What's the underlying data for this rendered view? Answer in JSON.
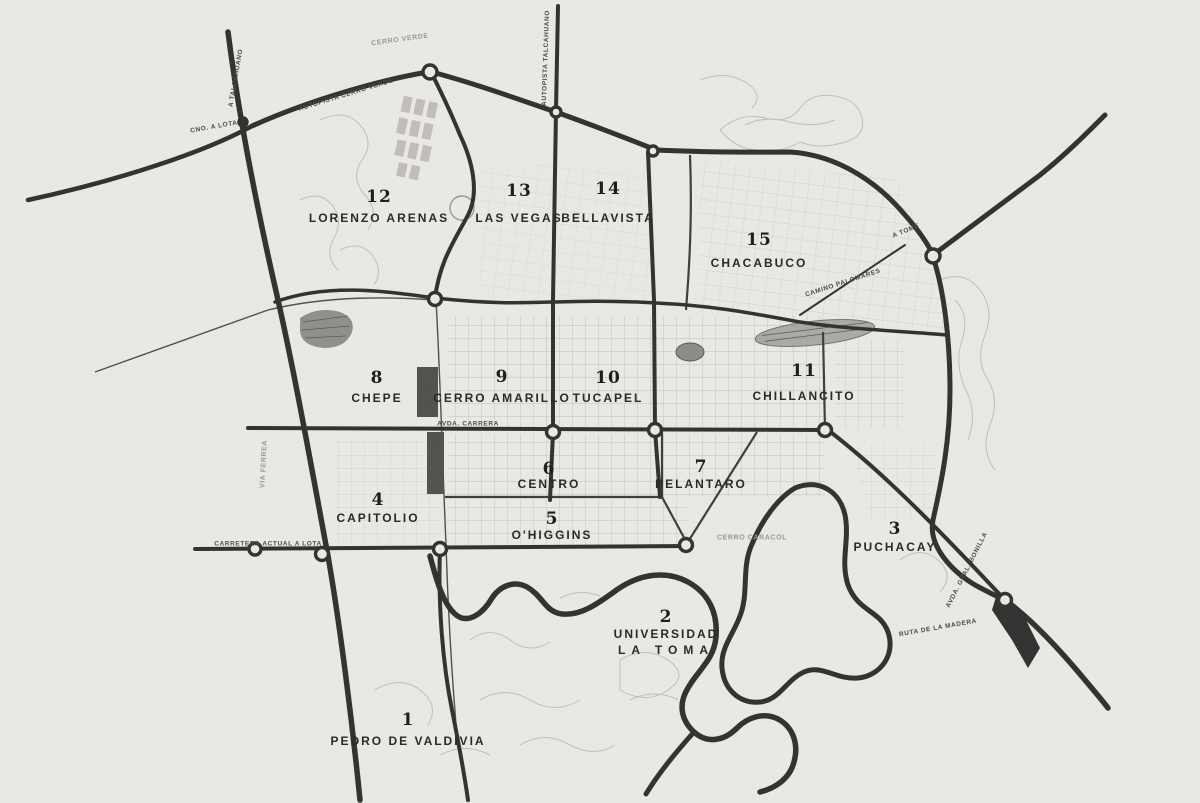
{
  "map": {
    "region_name": "Concepcion sector map",
    "background_color": "#ebeae7",
    "road_color": "#2d2c2a",
    "contour_color": "#c2bfb9",
    "label_color": "#2b2a28",
    "districts": [
      {
        "number": "1",
        "name": "PEDRO DE VALDIVIA",
        "x": 408,
        "y": 720,
        "dy": 21
      },
      {
        "number": "2",
        "name": "UNIVERSIDAD",
        "name2": "LA TOMA",
        "x": 666,
        "y": 617,
        "dy": 17
      },
      {
        "number": "3",
        "name": "PUCHACAY",
        "x": 895,
        "y": 529,
        "dy": 18
      },
      {
        "number": "4",
        "name": "CAPITOLIO",
        "x": 378,
        "y": 500,
        "dy": 18
      },
      {
        "number": "5",
        "name": "O'HIGGINS",
        "x": 552,
        "y": 519,
        "dy": 16
      },
      {
        "number": "6",
        "name": "CENTRO",
        "x": 549,
        "y": 469,
        "dy": 15
      },
      {
        "number": "7",
        "name": "PELANTARO",
        "x": 701,
        "y": 467,
        "dy": 17
      },
      {
        "number": "8",
        "name": "CHEPE",
        "x": 377,
        "y": 378,
        "dy": 20
      },
      {
        "number": "9",
        "name": "CERRO AMARILLO",
        "x": 502,
        "y": 377,
        "dy": 21
      },
      {
        "number": "10",
        "name": "TUCAPEL",
        "x": 608,
        "y": 378,
        "dy": 20
      },
      {
        "number": "11",
        "name": "CHILLANCITO",
        "x": 804,
        "y": 371,
        "dy": 25
      },
      {
        "number": "12",
        "name": "LORENZO ARENAS",
        "x": 379,
        "y": 197,
        "dy": 21
      },
      {
        "number": "13",
        "name": "LAS VEGAS",
        "x": 519,
        "y": 191,
        "dy": 27
      },
      {
        "number": "14",
        "name": "BELLAVISTA",
        "x": 608,
        "y": 189,
        "dy": 29
      },
      {
        "number": "15",
        "name": "CHACABUCO",
        "x": 759,
        "y": 240,
        "dy": 23
      }
    ],
    "road_labels": [
      {
        "text": "AUTOPISTA CERRO VERDE",
        "x": 346,
        "y": 95,
        "rot": -17
      },
      {
        "text": "CERRO VERDE",
        "x": 400,
        "y": 40,
        "rot": -8,
        "faint": true
      },
      {
        "text": "A TALCAHUANO",
        "x": 236,
        "y": 78,
        "rot": -80
      },
      {
        "text": "CNO. A LOTA",
        "x": 214,
        "y": 127,
        "rot": -10
      },
      {
        "text": "AUTOPISTA TALCAHUANO",
        "x": 546,
        "y": 58,
        "rot": -88
      },
      {
        "text": "A TOME",
        "x": 906,
        "y": 231,
        "rot": -22
      },
      {
        "text": "CAMINO PALOMARES",
        "x": 843,
        "y": 283,
        "rot": -18
      },
      {
        "text": "AVDA. CARRERA",
        "x": 468,
        "y": 424,
        "rot": 0
      },
      {
        "text": "CARRETERA ACTUAL A LOTA",
        "x": 268,
        "y": 544,
        "rot": 0
      },
      {
        "text": "VIA FERREA",
        "x": 264,
        "y": 464,
        "rot": -87,
        "faint": true
      },
      {
        "text": "CERRO CARACOL",
        "x": 752,
        "y": 538,
        "rot": 0,
        "faint": true
      },
      {
        "text": "AVDA. GRAL. BONILLA",
        "x": 967,
        "y": 570,
        "rot": -63
      },
      {
        "text": "RUTA DE LA MADERA",
        "x": 938,
        "y": 628,
        "rot": -10
      }
    ]
  }
}
